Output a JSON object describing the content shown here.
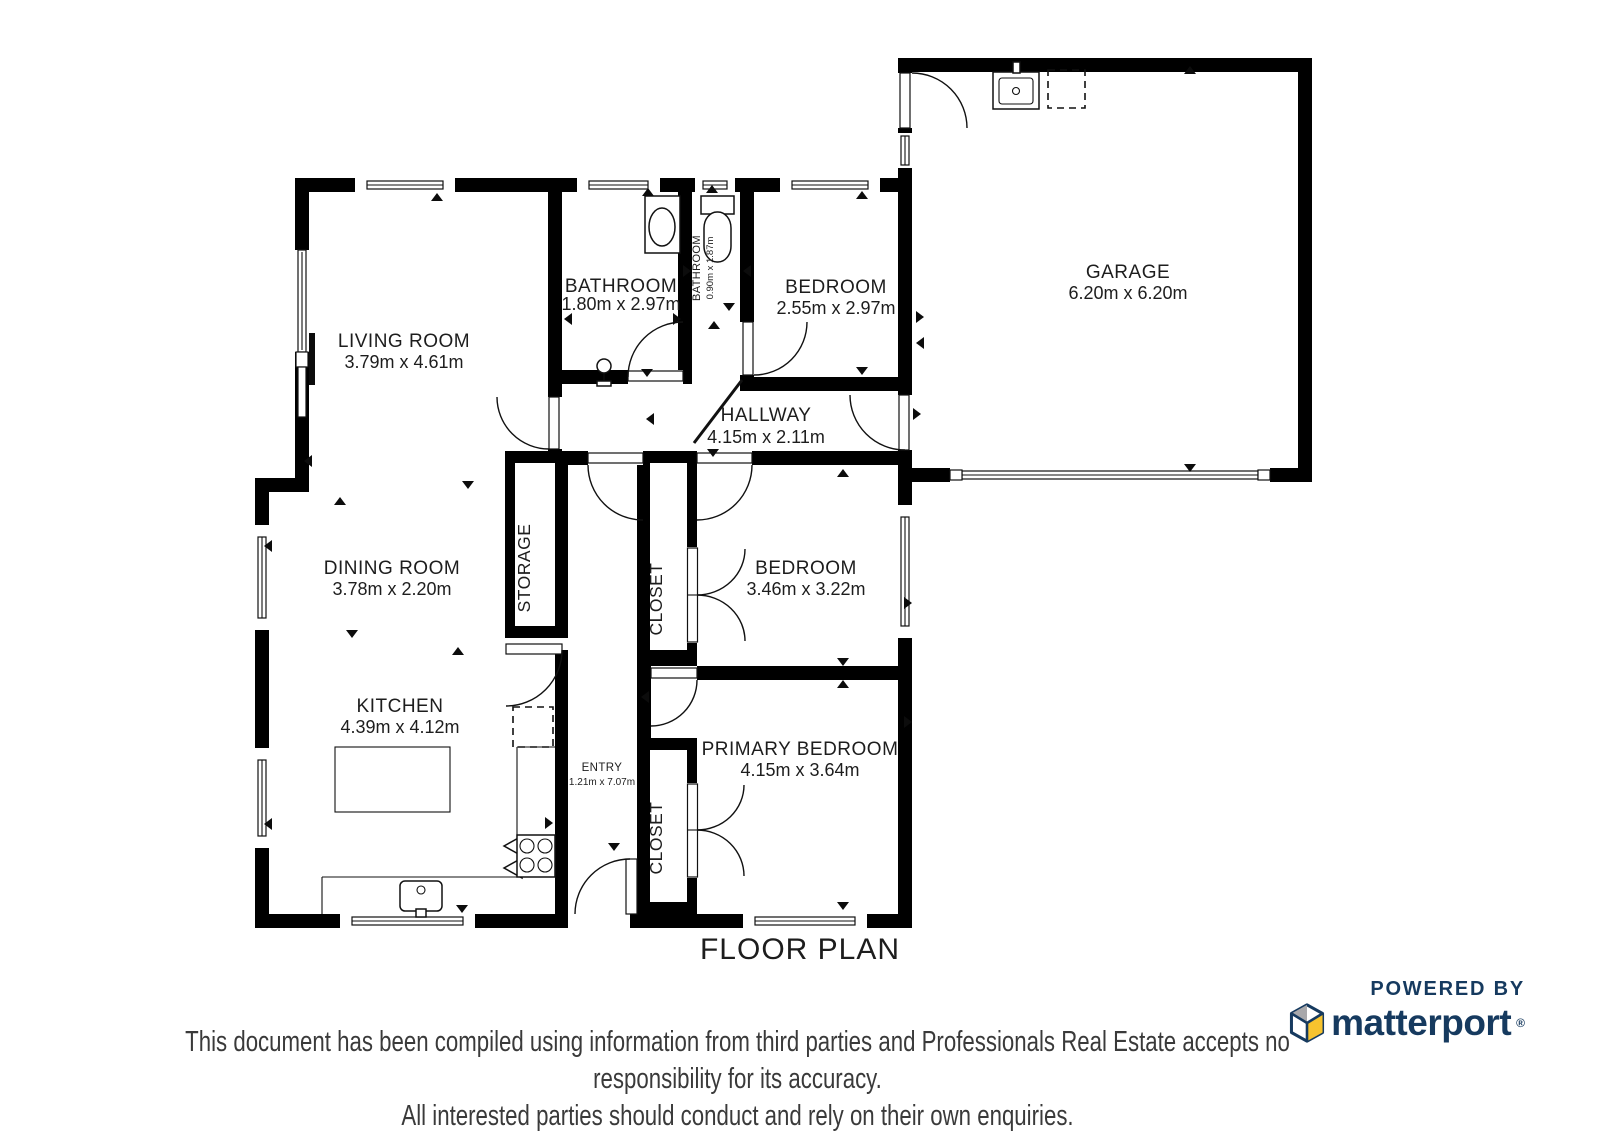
{
  "title": "FLOOR PLAN",
  "rooms": {
    "living": {
      "name": "LIVING ROOM",
      "dims": "3.79m x 4.61m"
    },
    "bathroom": {
      "name": "BATHROOM",
      "dims": "1.80m x 2.97m"
    },
    "bathroom_small": {
      "name": "BATHROOM",
      "dims": "0.90m x 1.87m"
    },
    "bedroom1": {
      "name": "BEDROOM",
      "dims": "2.55m x 2.97m"
    },
    "garage": {
      "name": "GARAGE",
      "dims": "6.20m x 6.20m"
    },
    "hallway": {
      "name": "HALLWAY",
      "dims": "4.15m x 2.11m"
    },
    "dining": {
      "name": "DINING ROOM",
      "dims": "3.78m x 2.20m"
    },
    "storage": {
      "name": "STORAGE"
    },
    "closet_upper": {
      "name": "CLOSET"
    },
    "bedroom2": {
      "name": "BEDROOM",
      "dims": "3.46m x 3.22m"
    },
    "kitchen": {
      "name": "KITCHEN",
      "dims": "4.39m x 4.12m"
    },
    "entry": {
      "name": "ENTRY",
      "dims": "1.21m x 7.07m"
    },
    "closet_lower": {
      "name": "CLOSET"
    },
    "primary": {
      "name": "PRIMARY BEDROOM",
      "dims": "4.15m x 3.64m"
    }
  },
  "branding": {
    "powered_by": "POWERED BY",
    "wordmark": "matterport",
    "registered": "®",
    "cube_icon": "matterport-cube-icon"
  },
  "disclaimer": {
    "line1": "This document has been compiled using information from third parties and Professionals Real Estate accepts no responsibility for its accuracy.",
    "line2": "All interested parties should conduct and rely on their own enquiries."
  },
  "colors": {
    "wall": "#000000",
    "label_text": "#1d1d1d",
    "brand_navy": "#163a5f",
    "brand_yellow": "#f7c32e",
    "brand_gray": "#a8a8ab",
    "disclaimer_text": "#3a3a3a"
  }
}
